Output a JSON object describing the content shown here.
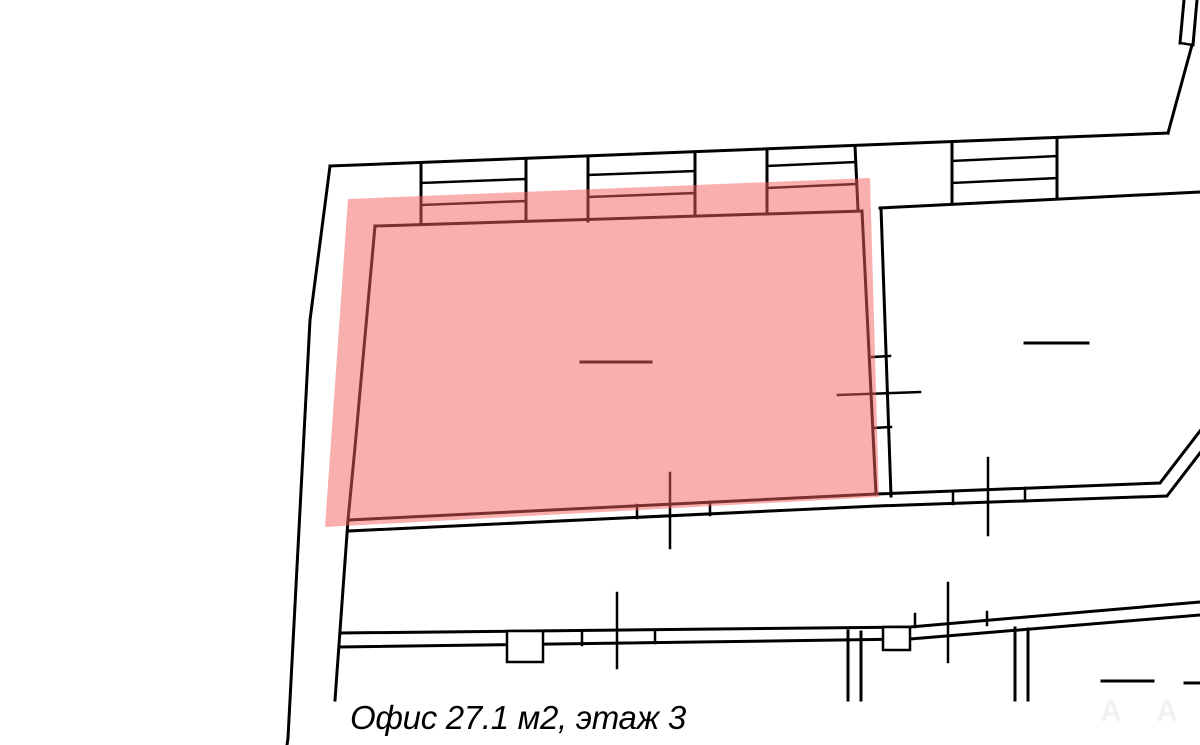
{
  "plan": {
    "background": "#ffffff",
    "stroke_color": "#000000",
    "highlight": {
      "label": "selected-office-area",
      "fill": "#f65f5f",
      "opacity": 0.5,
      "polygon": "348,199 870,178 879,497 325,527"
    },
    "walls": [
      {
        "pts": "330,166 310,320 288,738 287,745",
        "w": 3
      },
      {
        "pts": "330,166 1168,133",
        "w": 3
      },
      {
        "pts": "1192,45 1168,133",
        "w": 3
      },
      {
        "pts": "1184,0 1180,43",
        "w": 3
      },
      {
        "pts": "1197,0 1193,45",
        "w": 3
      },
      {
        "pts": "1180,43 1193,45",
        "w": 2.5
      },
      {
        "pts": "421,163 421,223",
        "w": 3
      },
      {
        "pts": "526,159 526,219",
        "w": 3
      },
      {
        "pts": "588,156 588,221",
        "w": 3
      },
      {
        "pts": "695,152 695,216",
        "w": 3
      },
      {
        "pts": "767,149 767,212",
        "w": 3
      },
      {
        "pts": "855,146 858,210",
        "w": 3
      },
      {
        "pts": "952,142 952,204",
        "w": 3
      },
      {
        "pts": "1057,138 1057,198",
        "w": 3
      },
      {
        "pts": "421,183 526,179",
        "w": 2.5
      },
      {
        "pts": "421,205 526,201",
        "w": 2.5
      },
      {
        "pts": "588,175 695,171",
        "w": 2.5
      },
      {
        "pts": "588,197 695,193",
        "w": 2.5
      },
      {
        "pts": "767,166 855,162",
        "w": 2.5
      },
      {
        "pts": "767,188 855,184",
        "w": 2.5
      },
      {
        "pts": "952,161 1057,156",
        "w": 2.5
      },
      {
        "pts": "952,183 1057,178",
        "w": 2.5
      },
      {
        "pts": "880,208 1200,192",
        "w": 3
      },
      {
        "pts": "375,226 862,211",
        "w": 3
      },
      {
        "pts": "375,226 355,447 348,520 335,700",
        "w": 3
      },
      {
        "pts": "862,211 876,494",
        "w": 3
      },
      {
        "pts": "881,208 891,496",
        "w": 3
      },
      {
        "pts": "872,357 890,356",
        "w": 2.5
      },
      {
        "pts": "873,428 891,427",
        "w": 2.5
      },
      {
        "pts": "838,395 920,392",
        "w": 2.5
      },
      {
        "pts": "348,520 876,494 1160,483 1200,431",
        "w": 3
      },
      {
        "pts": "348,531 877,506 1167,496 1200,453",
        "w": 3
      },
      {
        "pts": "637,505 637,518",
        "w": 2.5
      },
      {
        "pts": "710,502 710,515",
        "w": 2.5
      },
      {
        "pts": "670,473 670,548",
        "w": 2.5
      },
      {
        "pts": "953,491 953,504",
        "w": 2.5
      },
      {
        "pts": "1025,488 1025,501",
        "w": 2.5
      },
      {
        "pts": "988,458 988,535",
        "w": 2.5
      },
      {
        "pts": "340,633 910,627 1200,602",
        "w": 3
      },
      {
        "pts": "340,647 910,639 1200,615",
        "w": 3
      },
      {
        "pts": "582,632 582,645",
        "w": 2.5
      },
      {
        "pts": "655,630 655,643",
        "w": 2.5
      },
      {
        "pts": "617,593 617,668",
        "w": 2.5
      },
      {
        "pts": "915,614 915,627",
        "w": 2.5
      },
      {
        "pts": "987,612 987,625",
        "w": 2.5
      },
      {
        "pts": "948,583 948,662",
        "w": 2.5
      },
      {
        "pts": "848,631 848,700",
        "w": 3
      },
      {
        "pts": "861,632 861,700",
        "w": 3
      },
      {
        "pts": "1015,628 1015,700",
        "w": 3
      },
      {
        "pts": "1028,629 1028,700",
        "w": 3
      },
      {
        "pts": "1025,343 1088,343",
        "w": 3
      },
      {
        "pts": "581,362 651,362",
        "w": 3
      },
      {
        "pts": "1102,681 1153,681",
        "w": 3
      },
      {
        "pts": "1185,683 1200,683",
        "w": 3
      }
    ],
    "pilasters": [
      {
        "x": 507,
        "y": 631,
        "w": 36,
        "h": 31
      },
      {
        "x": 883,
        "y": 627,
        "w": 27,
        "h": 23
      }
    ]
  },
  "caption": {
    "text": "Офис 27.1 м2, этаж 3"
  },
  "watermarks": [
    {
      "text": "А"
    },
    {
      "text": "А"
    }
  ]
}
